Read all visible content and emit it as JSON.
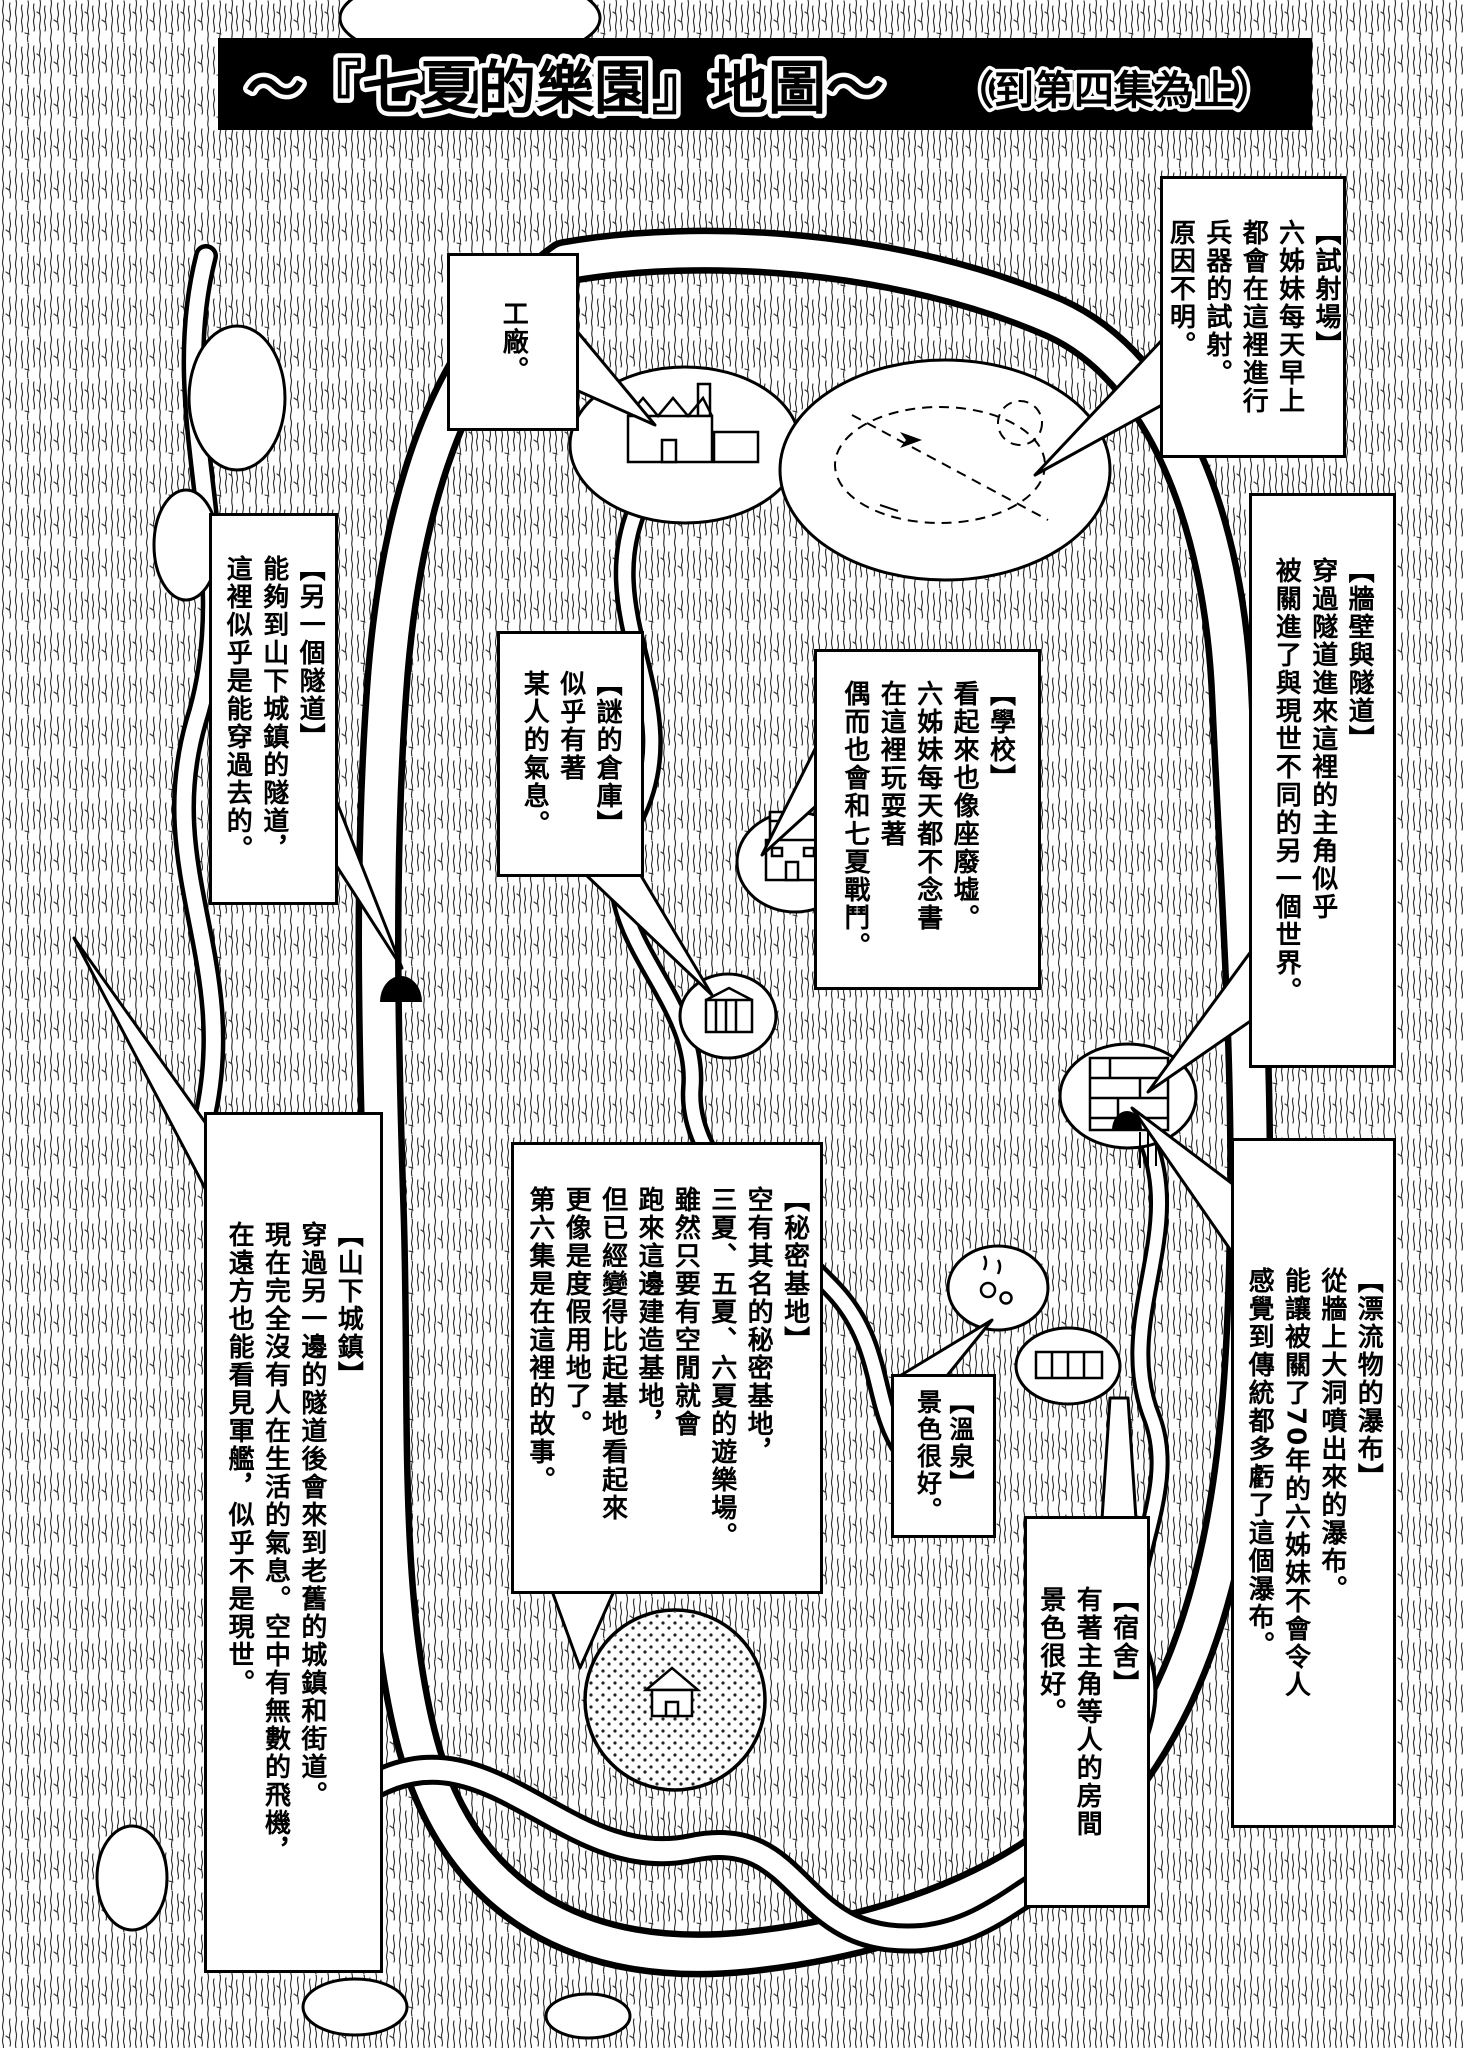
{
  "title": {
    "main": "～『七夏的樂園』地圖～",
    "suffix": "（到第四集為止）"
  },
  "colors": {
    "banner_bg": "#000000",
    "ink": "#000000",
    "paper": "#ffffff"
  },
  "callouts": {
    "factory": {
      "lines": [
        "工廠。"
      ]
    },
    "test_range": {
      "lines": [
        "【試射場】",
        "六姊妹每天早上",
        "都會在這裡進行",
        "兵器的試射。",
        "原因不明。"
      ]
    },
    "wall_tunnel": {
      "lines": [
        "【牆壁與隧道】",
        "穿過隧道進來這裡的主角似乎",
        "被關進了與現世不同的另一個世界。"
      ]
    },
    "another_tunnel": {
      "lines": [
        "【另一個隧道】",
        "能夠到山下城鎮的隧道，",
        "這裡似乎是能穿過去的。"
      ]
    },
    "mystery_warehouse": {
      "lines": [
        "【謎的倉庫】",
        "似乎有著",
        "某人的氣息。"
      ]
    },
    "school": {
      "lines": [
        "【學校】",
        "看起來也像座廢墟。",
        "六姊妹每天都不念書",
        "在這裡玩耍著",
        "偶而也會和七夏戰鬥。"
      ]
    },
    "downhill_town": {
      "lines": [
        "【山下城鎮】",
        "穿過另一邊的隧道後會來到老舊的城鎮和街道。",
        "現在完全沒有人在生活的氣息。空中有無數的飛機，",
        "在遠方也能看見軍艦，似乎不是現世。"
      ]
    },
    "secret_base": {
      "lines": [
        "【秘密基地】",
        "空有其名的秘密基地，",
        "三夏、五夏、六夏的遊樂場。",
        "雖然只要有空閒就會",
        "跑來這邊建造基地，",
        "但已經變得比起基地看起來",
        "更像是度假用地了。",
        "第六集是在這裡的故事。"
      ]
    },
    "driftwood_waterfall": {
      "lines": [
        "【漂流物的瀑布】",
        "從牆上大洞噴出來的瀑布。",
        "能讓被關了70年的六姊妹不會令人",
        "感覺到傳統都多虧了這個瀑布。"
      ]
    },
    "hot_spring": {
      "lines": [
        "【溫泉】",
        "景色很好。"
      ]
    },
    "dormitory": {
      "lines": [
        "【宿舍】",
        "有著主角等人的房間",
        "景色很好。"
      ]
    }
  }
}
